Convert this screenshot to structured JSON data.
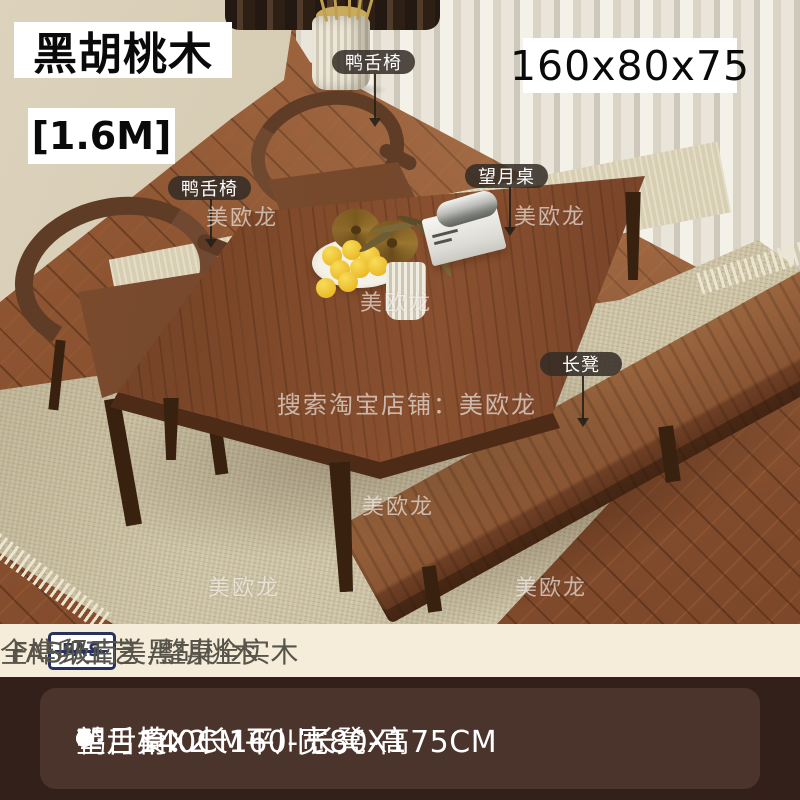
{
  "badges": {
    "material": "黑胡桃木",
    "length": "[1.6M]",
    "dimensions": "160x80x75"
  },
  "callouts": [
    {
      "label": "鸭舌椅"
    },
    {
      "label": "鸭舌椅"
    },
    {
      "label": "望月桌"
    },
    {
      "label": "长凳"
    }
  ],
  "watermark": {
    "brand": "美欧龙",
    "search": "搜索淘宝店铺：美欧龙"
  },
  "info_bar": {
    "logo_text": "FAS",
    "material_grade": "FAS级南美黑胡桃木",
    "craft": "全榫卯工艺 /整桌全实木"
  },
  "specs": {
    "line1": "望月桌：长160-宽80-高75CM",
    "line2_left": "鸭舌椅X2",
    "line2_right": "140CM平川长凳X1"
  },
  "colors": {
    "info_bar_bg": "#f5ecd9",
    "spec_panel_bg": "#33201a",
    "spec_card_bg": "#4b342c",
    "callout_bg": "rgba(50,44,38,0.85)",
    "badge_bg": "#ffffff",
    "badge_text": "#0a0a0a",
    "fas_logo_navy": "#27335e",
    "walnut_wood": "#7c4729"
  }
}
